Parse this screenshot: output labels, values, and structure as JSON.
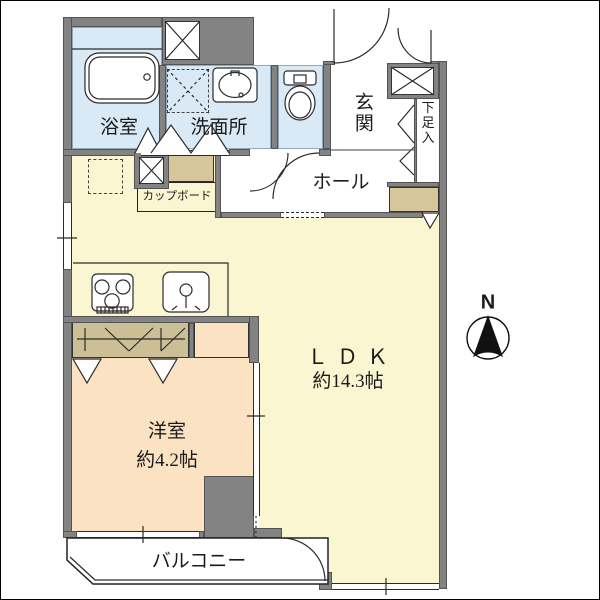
{
  "title": "apartment-floor-plan",
  "labels": {
    "bathroom": "浴室",
    "washroom": "洗面所",
    "entrance": "玄関",
    "shoe_cabinet": "下足入",
    "hall": "ホール",
    "cupboard": "カップボード",
    "ldk_name": "ＬＤＫ",
    "ldk_size": "約14.3帖",
    "bedroom_name": "洋室",
    "bedroom_size": "約4.2帖",
    "balcony": "バルコニー",
    "compass_north": "N"
  },
  "colors": {
    "wall": "#838383",
    "wet": "#D9EAF6",
    "ldk": "#FAF6D1",
    "bedroom": "#FBE2C3",
    "tan": "#D7C59C",
    "tanH": "#CDBF95"
  }
}
